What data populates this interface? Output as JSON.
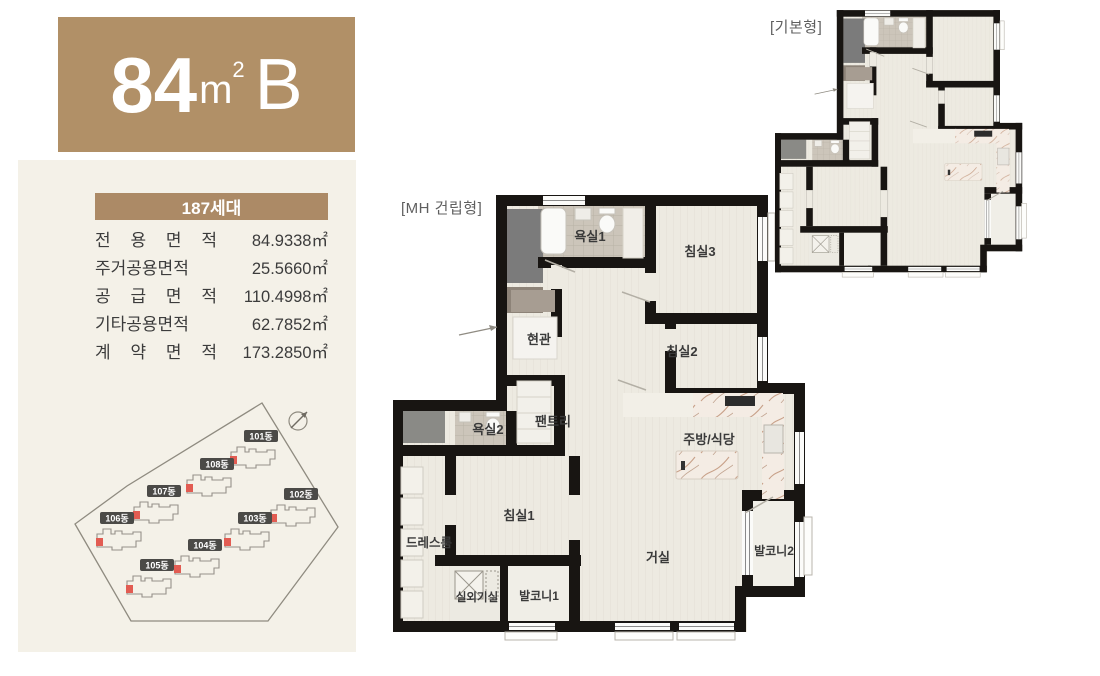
{
  "unit_card": {
    "size_number": "84",
    "size_unit": "m",
    "size_sup": "2",
    "size_type": "B"
  },
  "spec": {
    "header": "187세대",
    "rows": [
      {
        "label": "전 용 면 적",
        "value": "84.9338㎡"
      },
      {
        "label": "주거공용면적",
        "value": "25.5660㎡"
      },
      {
        "label": "공 급 면 적",
        "value": "110.4998㎡"
      },
      {
        "label": "기타공용면적",
        "value": "62.7852㎡"
      },
      {
        "label": "계 약 면 적",
        "value": "173.2850㎡"
      }
    ]
  },
  "site": {
    "buildings": [
      {
        "label": "101동"
      },
      {
        "label": "108동"
      },
      {
        "label": "107동"
      },
      {
        "label": "106동"
      },
      {
        "label": "102동"
      },
      {
        "label": "103동"
      },
      {
        "label": "104동"
      },
      {
        "label": "105동"
      }
    ]
  },
  "plans": {
    "main_label": "[MH 건립형]",
    "basic_label": "[기본형]",
    "rooms": {
      "bath1": "욕실1",
      "bed3": "침실3",
      "entrance": "현관",
      "bed2": "침실2",
      "pantry": "팬트리",
      "bath2": "욕실2",
      "kitchen": "주방/식당",
      "dressroom": "드레스룸",
      "bed1": "침실1",
      "living": "거실",
      "balcony2": "발코니2",
      "outdoor_unit": "실외기실",
      "balcony1": "발코니1"
    }
  },
  "colors": {
    "brand_brown": "#b19067",
    "bar_brown": "#ac8a66",
    "panel_cream": "#f4f1e8",
    "wall_black": "#181512",
    "floor": "#edeae1",
    "unit_red": "#e25c52",
    "badge_gray": "#4b4a47"
  }
}
